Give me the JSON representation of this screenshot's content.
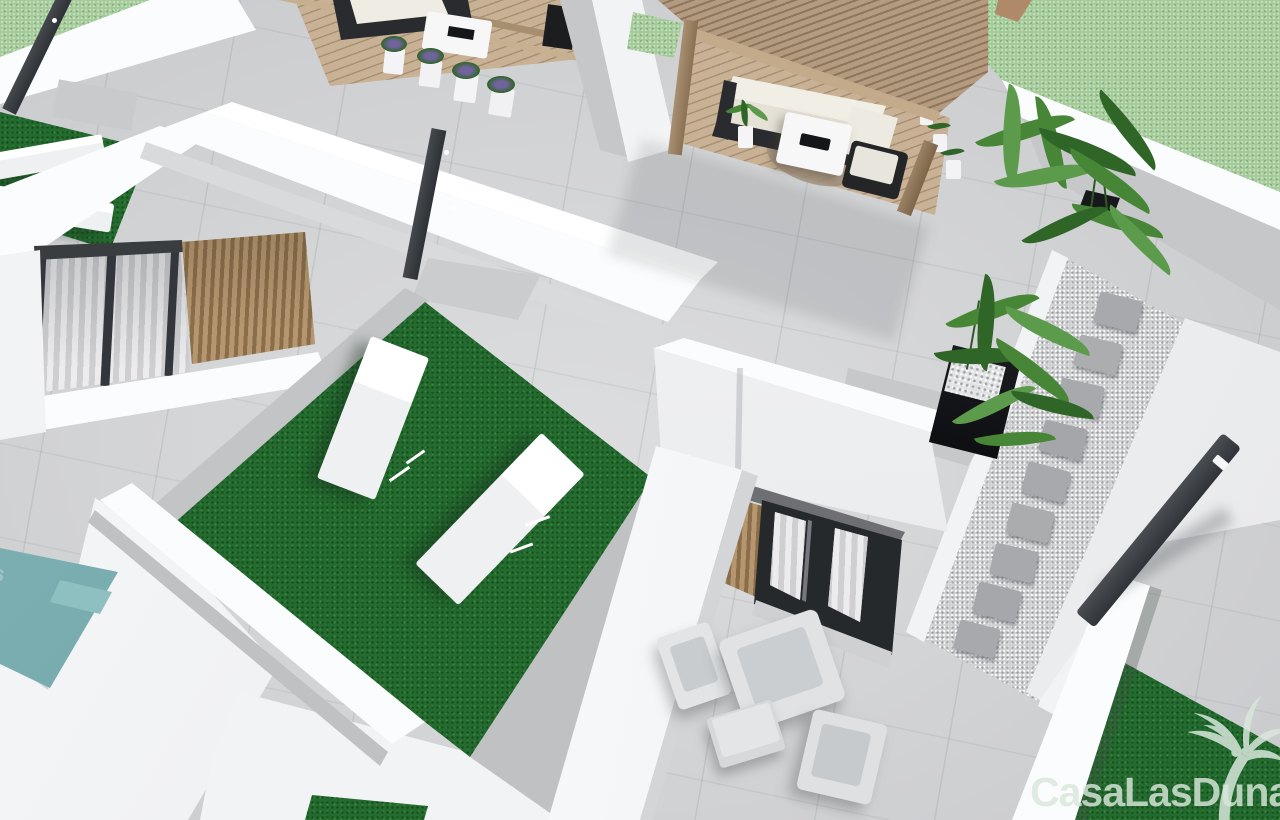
{
  "scene": {
    "type": "3d-architectural-render",
    "view": "aerial",
    "description": "Aerial 3D render of a modern white villa rooftop solarium with artificial lawn, sun loungers, wooden pergola lounge, plants, gravel path, swimming pool corner and ground-floor terrace"
  },
  "watermark": {
    "text": "CasaLasDunas",
    "icon": "palm-tree-icon",
    "color": "#d9e7dc"
  },
  "palette": {
    "paving": "#d5d6d8",
    "pavingDark": "#c6c7c9",
    "pavingDarker": "#b7b8ba",
    "white": "#f2f3f5",
    "whiteBright": "#fbfcfd",
    "whiteShade": "#e3e4e6",
    "lawn": "#236b2e",
    "lawnDark": "#184f20",
    "grass": "#a6cb9b",
    "pool": "#73a9ab",
    "poolStep": "#8fc0c1",
    "wood": "#b49b7f",
    "woodDark": "#8d765c",
    "woodLight": "#c8b194",
    "anthracite": "#383c40",
    "black": "#15161a",
    "wicker": "#2a2b2e",
    "cushion": "#efece3",
    "furn": "#d9dbdd",
    "furnDark": "#c3c6c8",
    "gravel": "#d0d1d3",
    "stone": "#a8a9ac",
    "leaf": "#478636",
    "leafDark": "#2f6527",
    "leafLight": "#5d9b4c",
    "lavender": "#6f649b",
    "watermark": "#d9e7dc"
  }
}
